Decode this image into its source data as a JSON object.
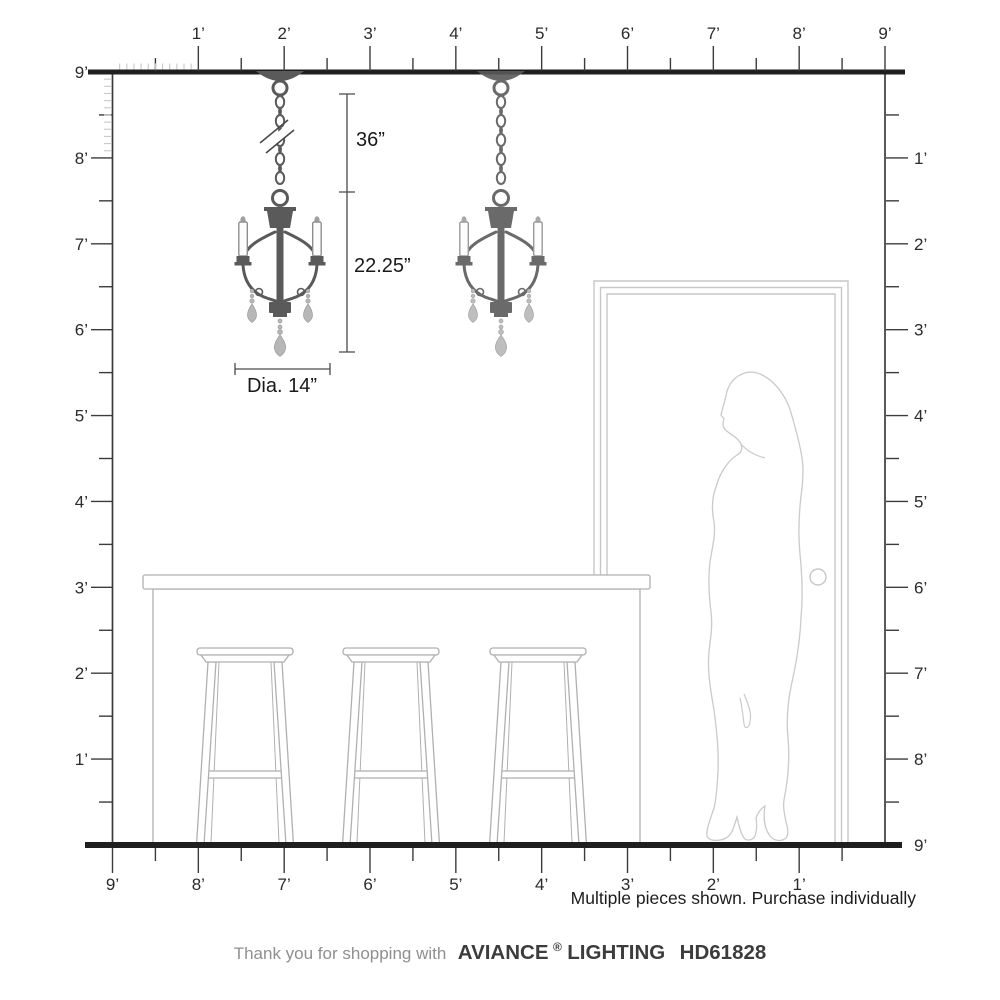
{
  "rulers": {
    "top": {
      "unit_labels": [
        "1’",
        "2’",
        "3’",
        "4’",
        "5’",
        "6’",
        "7’",
        "8’",
        "9’"
      ]
    },
    "bottom": {
      "unit_labels": [
        "9’",
        "8’",
        "7’",
        "6’",
        "5’",
        "4’",
        "3’",
        "2’",
        "1’"
      ]
    },
    "left": {
      "unit_labels": [
        "9’",
        "8’",
        "7’",
        "6’",
        "5’",
        "4’",
        "3’",
        "2’",
        "1’"
      ]
    },
    "right": {
      "unit_labels": [
        "1’",
        "2’",
        "3’",
        "4’",
        "5’",
        "6’",
        "7’",
        "8’"
      ],
      "floor_label": "9’"
    }
  },
  "dimensions": {
    "chain_length": "36”",
    "fixture_height": "22.25”",
    "diameter": "Dia. 14”"
  },
  "note": "Multiple pieces shown. Purchase individually",
  "footer": {
    "prefix": "Thank you for shopping with",
    "brand": "AVIANCE",
    "registered": "®",
    "brand_suffix": "LIGHTING",
    "model": "HD61828"
  },
  "colors": {
    "heavy_line": "#1f1f1f",
    "wall_line": "#3b3b3b",
    "label": "#2b2b2b",
    "inch_tick": "#c9c9c9",
    "dim_line": "#4a4a4a",
    "dim_text": "#1a1a1a",
    "fixture": "#5a5a5a",
    "crystal": "#b7b7b7",
    "candle_outline": "#8f8f8f",
    "furniture_outline": "#b0b0b0",
    "door_outline": "#c7c7c7",
    "silhouette_outline": "#cacaca",
    "note_text": "#1c1c1c",
    "footer_muted": "#8f8f8f",
    "footer_brand": "#3c3c3c"
  }
}
